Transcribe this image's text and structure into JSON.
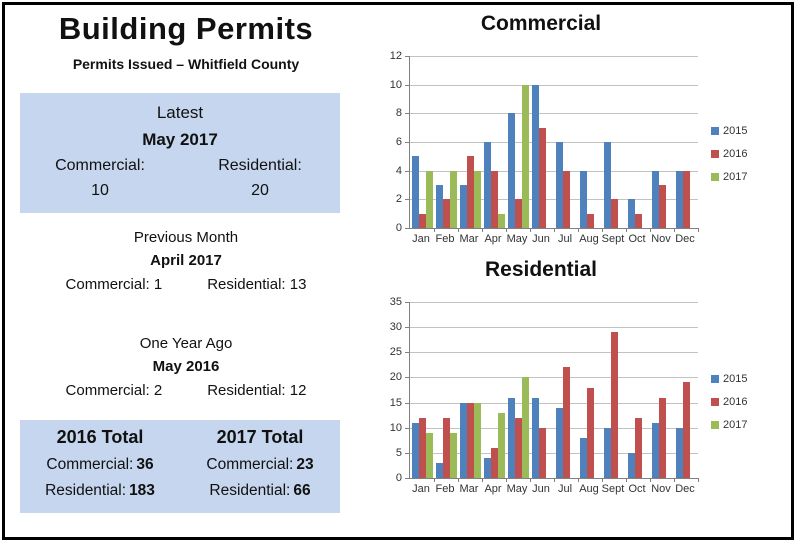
{
  "colors": {
    "panel_bg": "#C5D6EE",
    "series_2015": "#4F81BD",
    "series_2016": "#C0504D",
    "series_2017": "#9BBB59",
    "gridline": "#C2C2C2",
    "axis": "#808080"
  },
  "header": {
    "title": "Building Permits",
    "subtitle": "Permits Issued – Whitfield County"
  },
  "latest": {
    "heading": "Latest",
    "month": "May 2017",
    "commercial_label": "Commercial:",
    "commercial_value": "10",
    "residential_label": "Residential:",
    "residential_value": "20"
  },
  "previous_month": {
    "heading": "Previous Month",
    "month": "April 2017",
    "commercial": "Commercial: 1",
    "residential": "Residential: 13"
  },
  "one_year_ago": {
    "heading": "One Year Ago",
    "month": "May 2016",
    "commercial": "Commercial: 2",
    "residential": "Residential: 12"
  },
  "totals": {
    "y2016": {
      "heading": "2016 Total",
      "commercial_label": "Commercial:",
      "commercial_value": "36",
      "residential_label": "Residential:",
      "residential_value": "183"
    },
    "y2017": {
      "heading": "2017 Total",
      "commercial_label": "Commercial:",
      "commercial_value": "23",
      "residential_label": "Residential:",
      "residential_value": "66"
    }
  },
  "chart_data": [
    {
      "type": "bar",
      "title": "Commercial",
      "categories": [
        "Jan",
        "Feb",
        "Mar",
        "Apr",
        "May",
        "Jun",
        "Jul",
        "Aug",
        "Sept",
        "Oct",
        "Nov",
        "Dec"
      ],
      "series": [
        {
          "name": "2015",
          "color": "#4F81BD",
          "values": [
            5,
            3,
            3,
            6,
            8,
            10,
            6,
            4,
            6,
            2,
            4,
            4
          ]
        },
        {
          "name": "2016",
          "color": "#C0504D",
          "values": [
            1,
            2,
            5,
            4,
            2,
            7,
            4,
            1,
            2,
            1,
            3,
            4
          ]
        },
        {
          "name": "2017",
          "color": "#9BBB59",
          "values": [
            4,
            4,
            4,
            1,
            10,
            null,
            null,
            null,
            null,
            null,
            null,
            null
          ]
        }
      ],
      "ylim": [
        0,
        12
      ],
      "ytick": 2,
      "grid": true,
      "legend_position": "right"
    },
    {
      "type": "bar",
      "title": "Residential",
      "categories": [
        "Jan",
        "Feb",
        "Mar",
        "Apr",
        "May",
        "Jun",
        "Jul",
        "Aug",
        "Sept",
        "Oct",
        "Nov",
        "Dec"
      ],
      "series": [
        {
          "name": "2015",
          "color": "#4F81BD",
          "values": [
            11,
            3,
            15,
            4,
            16,
            16,
            14,
            8,
            10,
            5,
            11,
            10
          ]
        },
        {
          "name": "2016",
          "color": "#C0504D",
          "values": [
            12,
            12,
            15,
            6,
            12,
            10,
            22,
            18,
            29,
            12,
            16,
            19
          ]
        },
        {
          "name": "2017",
          "color": "#9BBB59",
          "values": [
            9,
            9,
            15,
            13,
            20,
            null,
            null,
            null,
            null,
            null,
            null,
            null
          ]
        }
      ],
      "ylim": [
        0,
        35
      ],
      "ytick": 5,
      "grid": true,
      "legend_position": "right"
    }
  ]
}
